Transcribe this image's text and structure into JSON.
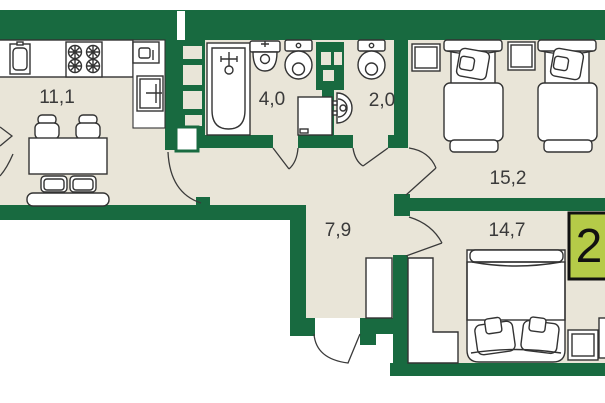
{
  "floorplan": {
    "type": "apartment-floor-plan",
    "badge": {
      "label": "2",
      "fill": "#b5cb48",
      "border": "#111111"
    },
    "rooms": [
      {
        "name": "kitchen-living-room",
        "area": "11,1"
      },
      {
        "name": "bathroom",
        "area": "4,0"
      },
      {
        "name": "toilet",
        "area": "2,0"
      },
      {
        "name": "bedroom-top-right",
        "area": "15,2"
      },
      {
        "name": "hallway",
        "area": "7,9"
      },
      {
        "name": "bedroom-bottom-right",
        "area": "14,7"
      }
    ],
    "colors": {
      "wall": "#186a40",
      "floor": "#e9e5d8",
      "outline": "#333333",
      "label_text": "#3a3a3a"
    },
    "furniture": {
      "kitchen-living-room": [
        "kitchen-sink",
        "stove",
        "small-appliance",
        "refrigerator",
        "dining-table",
        "chair",
        "chair",
        "seat",
        "seat",
        "bench"
      ],
      "bathroom": [
        "bathtub",
        "washbasin",
        "toilet",
        "washing-machine"
      ],
      "toilet": [
        "toilet",
        "corner-sink"
      ],
      "bedroom-top-right": [
        "nightstand",
        "single-bed",
        "nightstand",
        "single-bed"
      ],
      "bedroom-bottom-right": [
        "wardrobe",
        "double-bed",
        "nightstand",
        "cut-off-furniture"
      ],
      "hallway": [
        "closet"
      ]
    }
  }
}
